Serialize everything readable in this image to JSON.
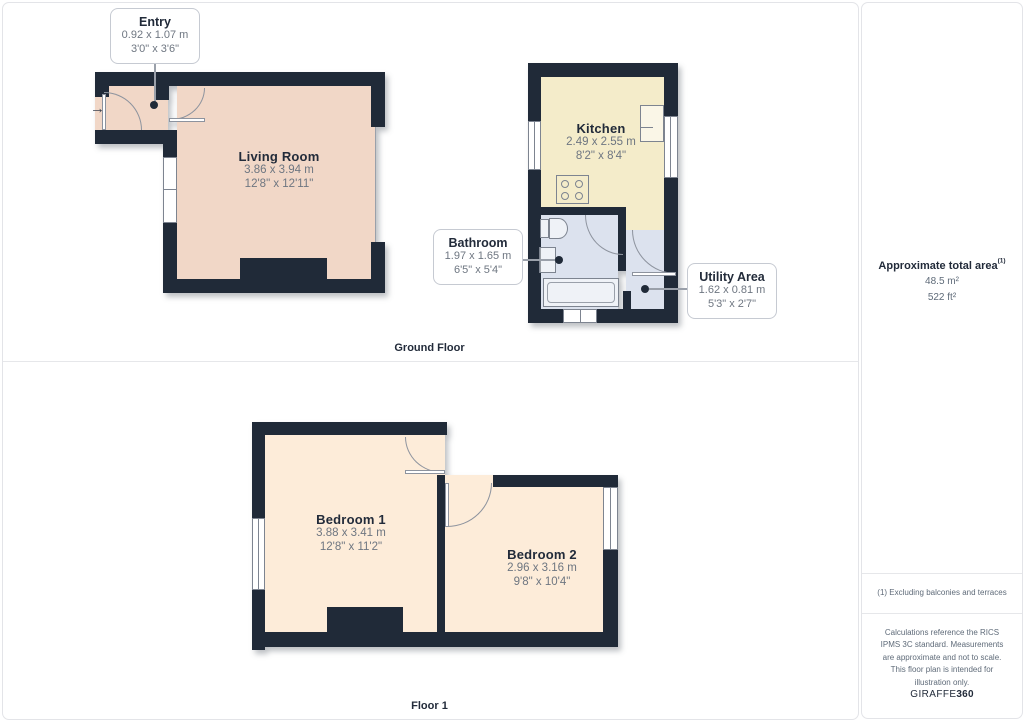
{
  "ground_floor": {
    "label": "Ground Floor",
    "rooms": {
      "living_room": {
        "name": "Living Room",
        "metric": "3.86 x 3.94 m",
        "imperial": "12'8\" x 12'11\""
      },
      "kitchen": {
        "name": "Kitchen",
        "metric": "2.49 x 2.55 m",
        "imperial": "8'2\" x 8'4\""
      }
    },
    "callouts": {
      "entry": {
        "name": "Entry",
        "metric": "0.92 x 1.07 m",
        "imperial": "3'0\" x 3'6\""
      },
      "bathroom": {
        "name": "Bathroom",
        "metric": "1.97 x 1.65 m",
        "imperial": "6'5\" x 5'4\""
      },
      "utility": {
        "name": "Utility Area",
        "metric": "1.62 x 0.81 m",
        "imperial": "5'3\" x 2'7\""
      }
    }
  },
  "floor1": {
    "label": "Floor 1",
    "rooms": {
      "bedroom1": {
        "name": "Bedroom 1",
        "metric": "3.88 x 3.41 m",
        "imperial": "12'8\" x 11'2\""
      },
      "bedroom2": {
        "name": "Bedroom 2",
        "metric": "2.96 x 3.16 m",
        "imperial": "9'8\" x 10'4\""
      }
    }
  },
  "sidebar": {
    "area_title": "Approximate total area",
    "area_footnote_marker": "(1)",
    "area_m2": "48.5 m²",
    "area_ft2": "522 ft²",
    "footnote": "(1) Excluding balconies and terraces",
    "disclaimer": "Calculations reference the RICS IPMS 3C standard. Measurements are approximate and not to scale. This floor plan is intended for illustration only.",
    "brand_normal": "GIRAFFE",
    "brand_bold": "360"
  },
  "colors": {
    "wall": "#202a38",
    "living_room_floor": "#f1d7c7",
    "bedroom_floor": "#fdecd9",
    "kitchen_floor": "#f4ecca",
    "bathroom_floor": "#dce2ee"
  }
}
